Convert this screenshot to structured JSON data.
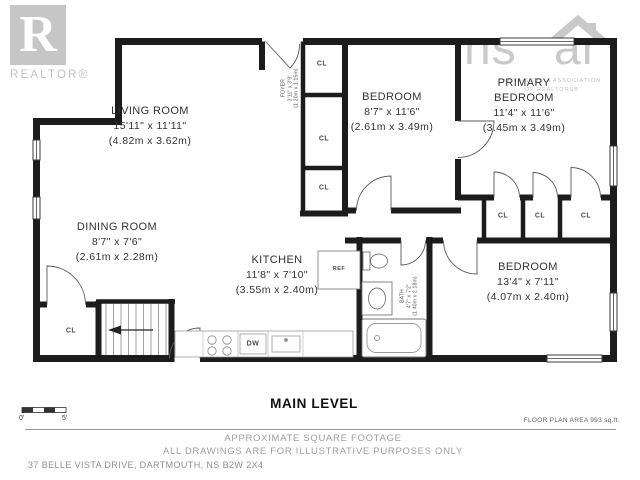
{
  "branding": {
    "realtor": {
      "letter": "R",
      "wordmark": "REALTOR®"
    },
    "nsar": {
      "left": "ns",
      "right": "ar",
      "assoc_line1": "NOVA SCOTIA ASSOCIATION",
      "assoc_line2": "OF REALTORS®"
    }
  },
  "rooms": {
    "living": {
      "name": "LIVING ROOM",
      "imperial": "15'11\" x 11'11\"",
      "metric": "(4.82m x 3.62m)"
    },
    "dining": {
      "name": "DINING ROOM",
      "imperial": "8'7\" x 7'6\"",
      "metric": "(2.61m x 2.28m)"
    },
    "kitchen": {
      "name": "KITCHEN",
      "imperial": "11'8\" x 7'10\"",
      "metric": "(3.55m x 2.40m)"
    },
    "bedroom_mid": {
      "name": "BEDROOM",
      "imperial": "8'7\" x 11'6\"",
      "metric": "(2.61m x 3.49m)"
    },
    "primary": {
      "name_line1": "PRIMARY",
      "name_line2": "BEDROOM",
      "imperial": "11'4\" x 11'6\"",
      "metric": "(3.45m x 3.49m)"
    },
    "bedroom_right": {
      "name": "BEDROOM",
      "imperial": "13'4\" x 7'11\"",
      "metric": "(4.07m x 2.40m)"
    },
    "foyer": {
      "name": "FOYER",
      "imperial": "3'11\" x 3'9\"",
      "metric": "(1.20m x 1.15m)"
    },
    "bath": {
      "name": "BATH",
      "imperial": "4'7\" x 7'2\"",
      "metric": "(1.40m x 2.18m)"
    }
  },
  "tags": {
    "closet": "CL",
    "fridge": "REF",
    "dishwasher": "DW"
  },
  "footer": {
    "level_title": "MAIN LEVEL",
    "area_note": "FLOOR PLAN AREA 993 sq.ft.",
    "scale_start": "0'",
    "scale_end": "5'",
    "disclaimer_line1": "APPROXIMATE SQUARE FOOTAGE",
    "disclaimer_line2": "ALL DRAWINGS ARE FOR ILLUSTRATIVE PURPOSES ONLY",
    "address": "37 BELLE VISTA DRIVE, DARTMOUTH, NS B2W 2X4"
  },
  "colors": {
    "wall": "#1c1c1c",
    "logo": "#c6c6c6",
    "muted_text": "#9e9e9e",
    "label_text": "#323232"
  }
}
